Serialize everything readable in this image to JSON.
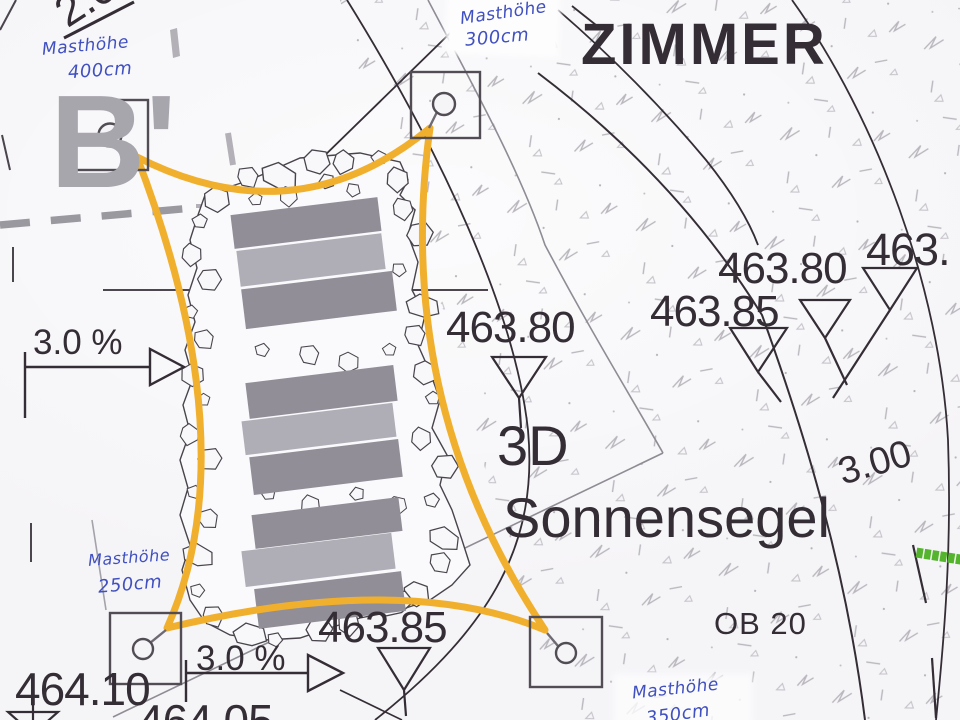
{
  "colors": {
    "paper": "#f5f4f7",
    "ink": "#342d35",
    "graytext": "#a8a6ad",
    "orange": "#f0b02e",
    "blue": "#4050c0",
    "green": "#55b42d",
    "linegray": "#8f8c94",
    "bardark": "#918e98",
    "barlight": "#afadb6",
    "stoneline": "#49444c",
    "texture": "#b9b7bd"
  },
  "title": {
    "text": "ZIMMER"
  },
  "section_marker": {
    "text": "B'"
  },
  "sail_label": {
    "line1": "3D",
    "line2": "Sonnensegel"
  },
  "area_label": {
    "text": "OB 20"
  },
  "dims": {
    "top_left": "2.0",
    "radius": "3.00"
  },
  "slopes": {
    "left": "3.0 %",
    "bottom": "3.0 %"
  },
  "elevations": {
    "center": "463.80",
    "right_80": "463.80",
    "right_85": "463.85",
    "right_edge": "463.",
    "bottom_center": "463.85",
    "bottom_left": "464.10",
    "bottom_edge": "464.05"
  },
  "mast_notes": {
    "top_left": {
      "l1": "Masthöhe",
      "l2": "400cm"
    },
    "top_right": {
      "l1": "Masthöhe",
      "l2": "300cm"
    },
    "bottom_left": {
      "l1": "Masthöhe",
      "l2": "250cm"
    },
    "bottom_right": {
      "l1": "Masthöhe",
      "l2": "350cm"
    }
  }
}
